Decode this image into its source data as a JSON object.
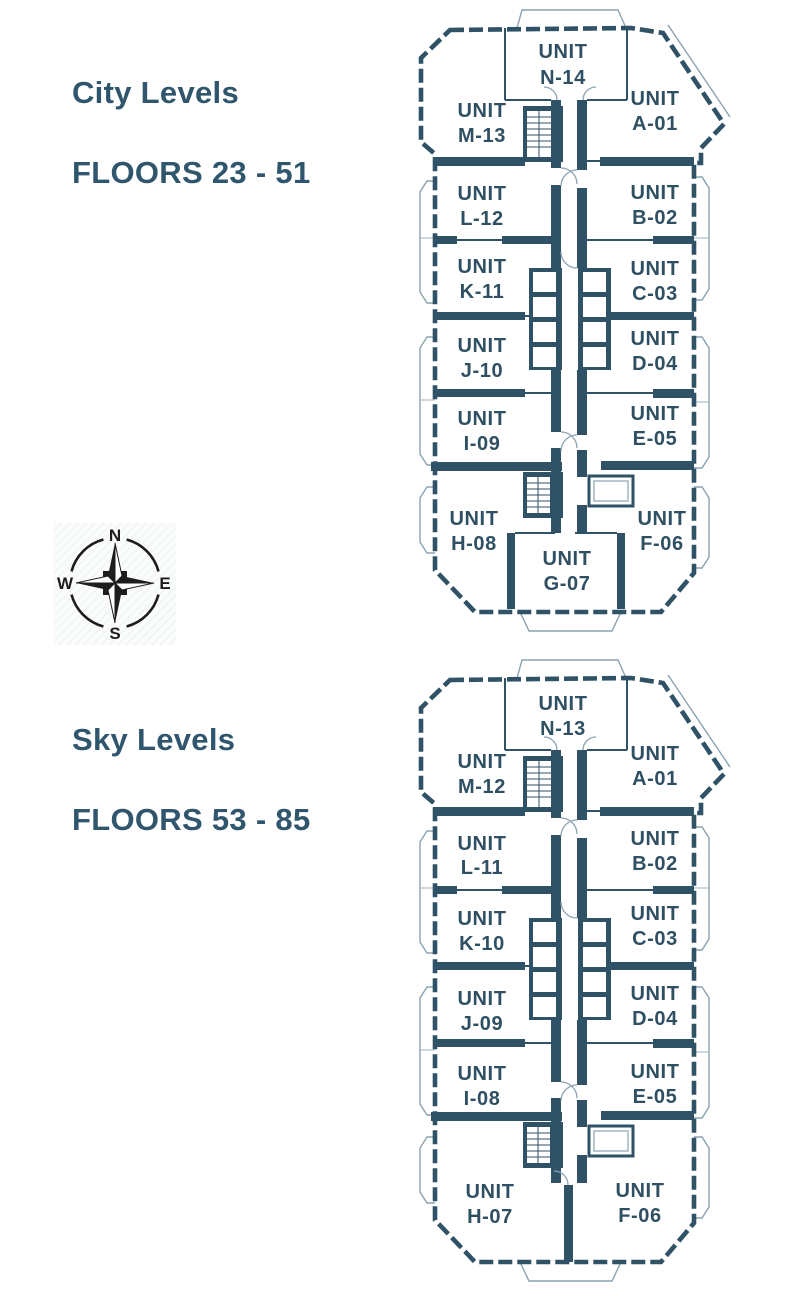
{
  "colors": {
    "wall": "#2f5267",
    "title_text": "#30566e",
    "unit_text": "#2f4f63",
    "balcony_outline": "#8aa2b2",
    "compass_ink": "#1d1d1d",
    "background": "#ffffff"
  },
  "sections": [
    {
      "id": "city-levels",
      "title_line1": "City Levels",
      "title_line2": "FLOORS 23 - 51",
      "units": [
        {
          "line1": "UNIT",
          "code": "N-14"
        },
        {
          "line1": "UNIT",
          "code": "M-13"
        },
        {
          "line1": "UNIT",
          "code": "A-01"
        },
        {
          "line1": "UNIT",
          "code": "L-12"
        },
        {
          "line1": "UNIT",
          "code": "B-02"
        },
        {
          "line1": "UNIT",
          "code": "K-11"
        },
        {
          "line1": "UNIT",
          "code": "C-03"
        },
        {
          "line1": "UNIT",
          "code": "J-10"
        },
        {
          "line1": "UNIT",
          "code": "D-04"
        },
        {
          "line1": "UNIT",
          "code": "I-09"
        },
        {
          "line1": "UNIT",
          "code": "E-05"
        },
        {
          "line1": "UNIT",
          "code": "H-08"
        },
        {
          "line1": "UNIT",
          "code": "F-06"
        },
        {
          "line1": "UNIT",
          "code": "G-07"
        }
      ]
    },
    {
      "id": "sky-levels",
      "title_line1": "Sky Levels",
      "title_line2": "FLOORS 53 - 85",
      "units": [
        {
          "line1": "UNIT",
          "code": "N-13"
        },
        {
          "line1": "UNIT",
          "code": "M-12"
        },
        {
          "line1": "UNIT",
          "code": "A-01"
        },
        {
          "line1": "UNIT",
          "code": "L-11"
        },
        {
          "line1": "UNIT",
          "code": "B-02"
        },
        {
          "line1": "UNIT",
          "code": "K-10"
        },
        {
          "line1": "UNIT",
          "code": "C-03"
        },
        {
          "line1": "UNIT",
          "code": "J-09"
        },
        {
          "line1": "UNIT",
          "code": "D-04"
        },
        {
          "line1": "UNIT",
          "code": "I-08"
        },
        {
          "line1": "UNIT",
          "code": "E-05"
        },
        {
          "line1": "UNIT",
          "code": "H-07"
        },
        {
          "line1": "UNIT",
          "code": "F-06"
        }
      ]
    }
  ],
  "compass": {
    "north": "N",
    "east": "E",
    "south": "S",
    "west": "W"
  }
}
